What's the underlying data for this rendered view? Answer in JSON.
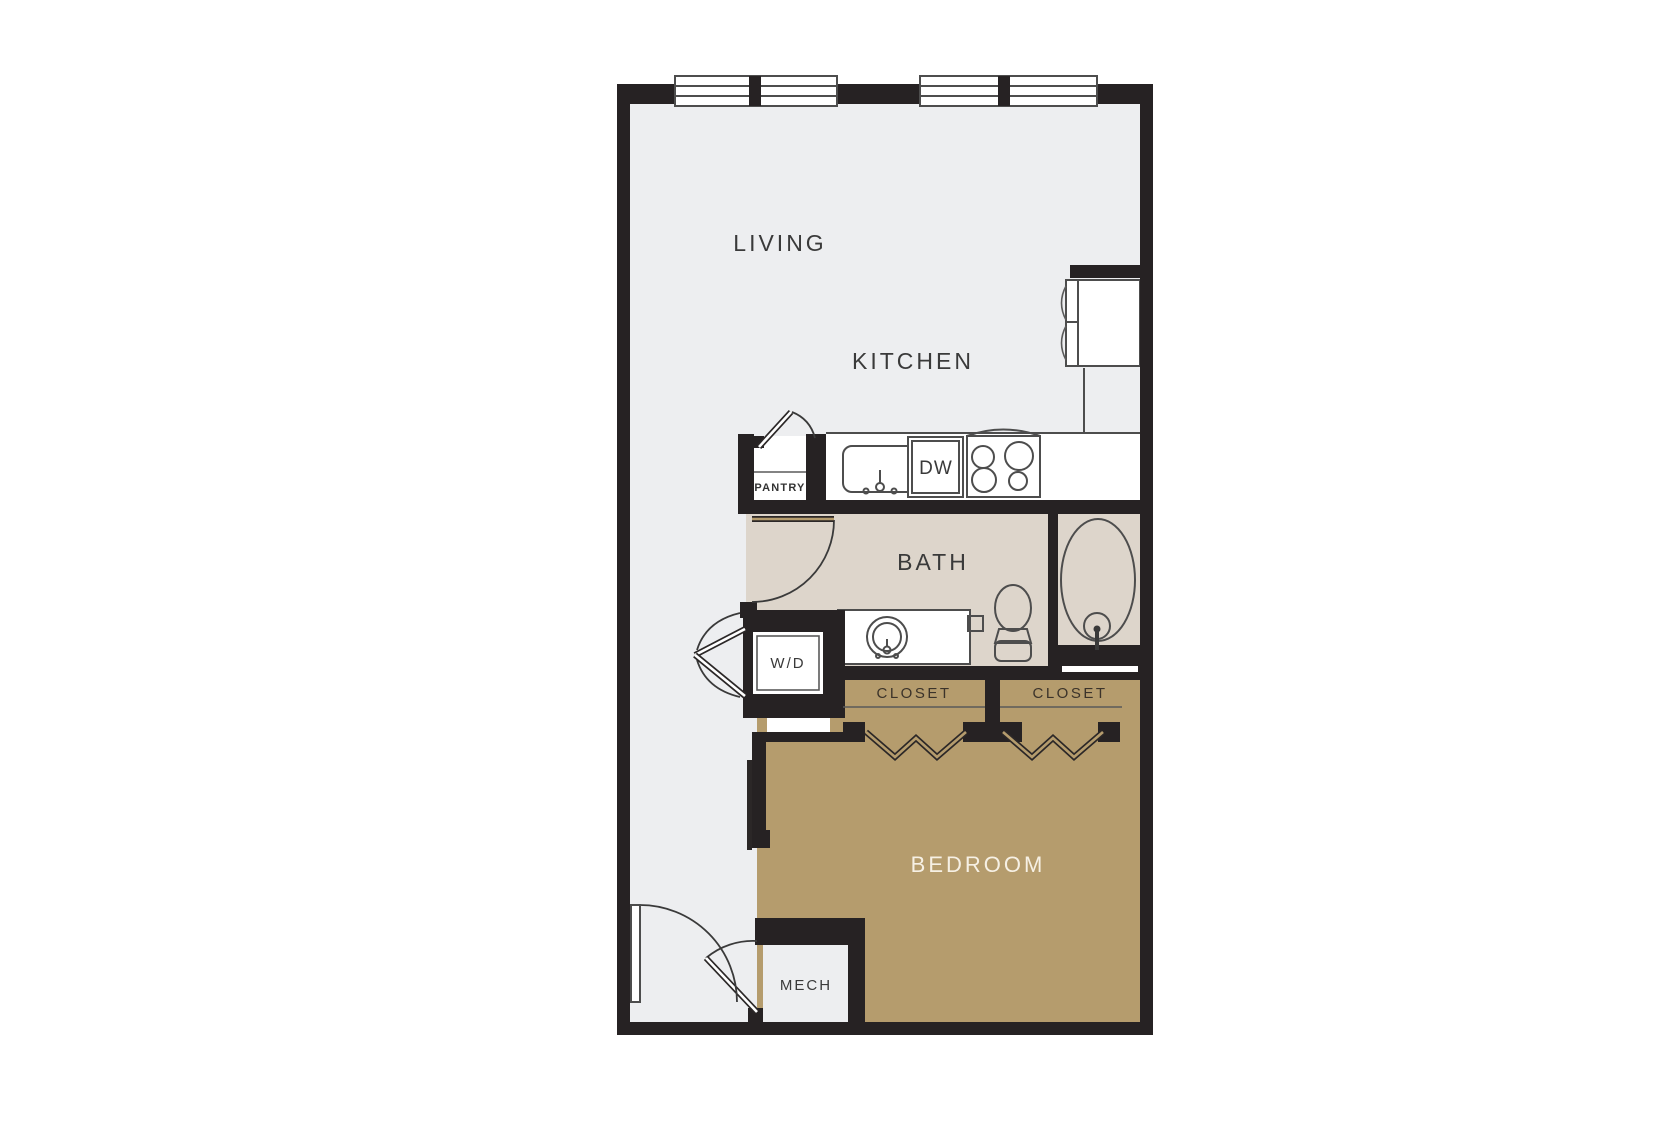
{
  "plan": {
    "type": "apartment-floor-plan",
    "labels": {
      "living": "LIVING",
      "kitchen": "KITCHEN",
      "pantry": "PANTRY",
      "dishwasher": "DW",
      "bath": "BATH",
      "washer_dryer": "W/D",
      "closet_left": "CLOSET",
      "closet_right": "CLOSET",
      "bedroom": "BEDROOM",
      "mech": "MECH"
    },
    "colors": {
      "background": "#ffffff",
      "wall": "#262223",
      "floor_main": "#edeef0",
      "floor_bath": "#ddd5cb",
      "floor_bedroom": "#b59c6d",
      "fixture_outline": "#4d4d4d",
      "label_dark": "#3a3a3a",
      "label_light": "#f6f0e4"
    }
  }
}
